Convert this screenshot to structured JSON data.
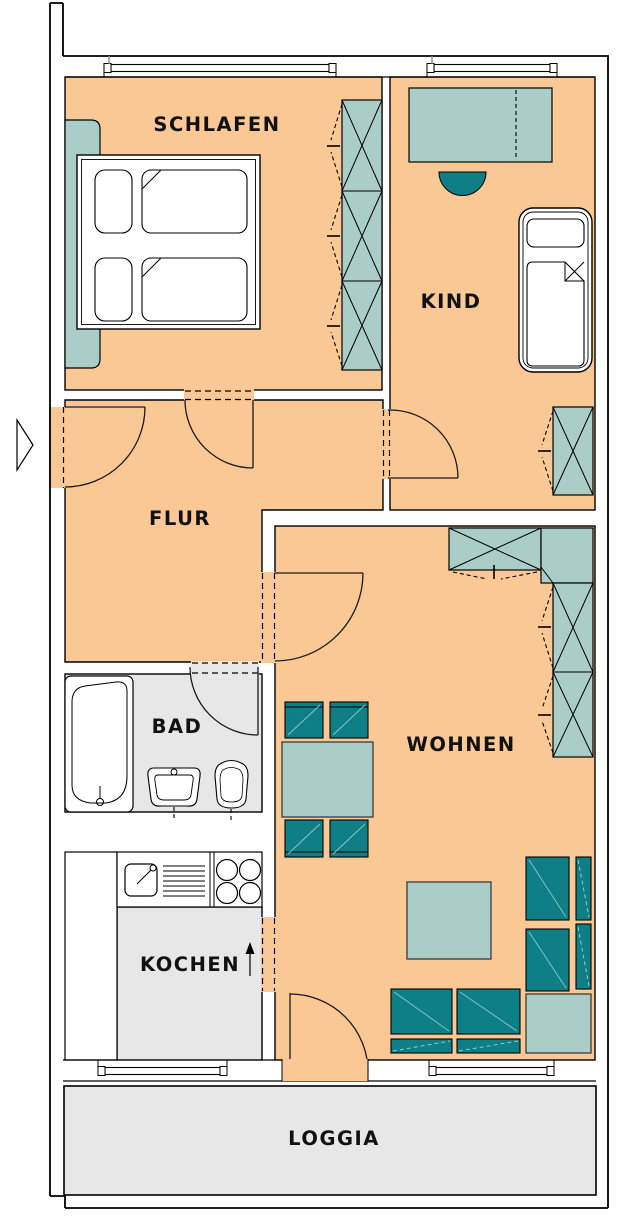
{
  "plan_title": "apartment-floor-plan",
  "rooms": [
    {
      "name": "schlafen",
      "label": "SCHLAFEN"
    },
    {
      "name": "kind",
      "label": "KIND"
    },
    {
      "name": "flur",
      "label": "FLUR"
    },
    {
      "name": "bad",
      "label": "BAD"
    },
    {
      "name": "wohnen",
      "label": "WOHNEN"
    },
    {
      "name": "kochen",
      "label": "KOCHEN"
    },
    {
      "name": "loggia",
      "label": "LOGGIA"
    }
  ],
  "colors": {
    "floor_orange": "#F9C894",
    "floor_gray": "#E7E7E7",
    "furniture_light_teal": "#ABCDC8",
    "furniture_dark_teal": "#0F7F87",
    "wall_line": "#000000",
    "background": "#FFFFFF"
  },
  "fixtures": [
    "double-bed",
    "closet-strip",
    "wardrobe-3-sections",
    "desk",
    "desk-chair",
    "child-bed",
    "wardrobe-1-section",
    "entrance-arrow",
    "bathtub",
    "washbasin",
    "toilet",
    "kitchen-counter",
    "kitchen-sink",
    "stove-4-burners",
    "tall-cabinet",
    "direction-arrow",
    "dining-table",
    "dining-chairs-4",
    "l-wardrobe",
    "coffee-table",
    "corner-table",
    "sofa-right-2-seats",
    "sofa-bottom-2-seats",
    "windows-4",
    "doors-6",
    "balcony-door"
  ]
}
